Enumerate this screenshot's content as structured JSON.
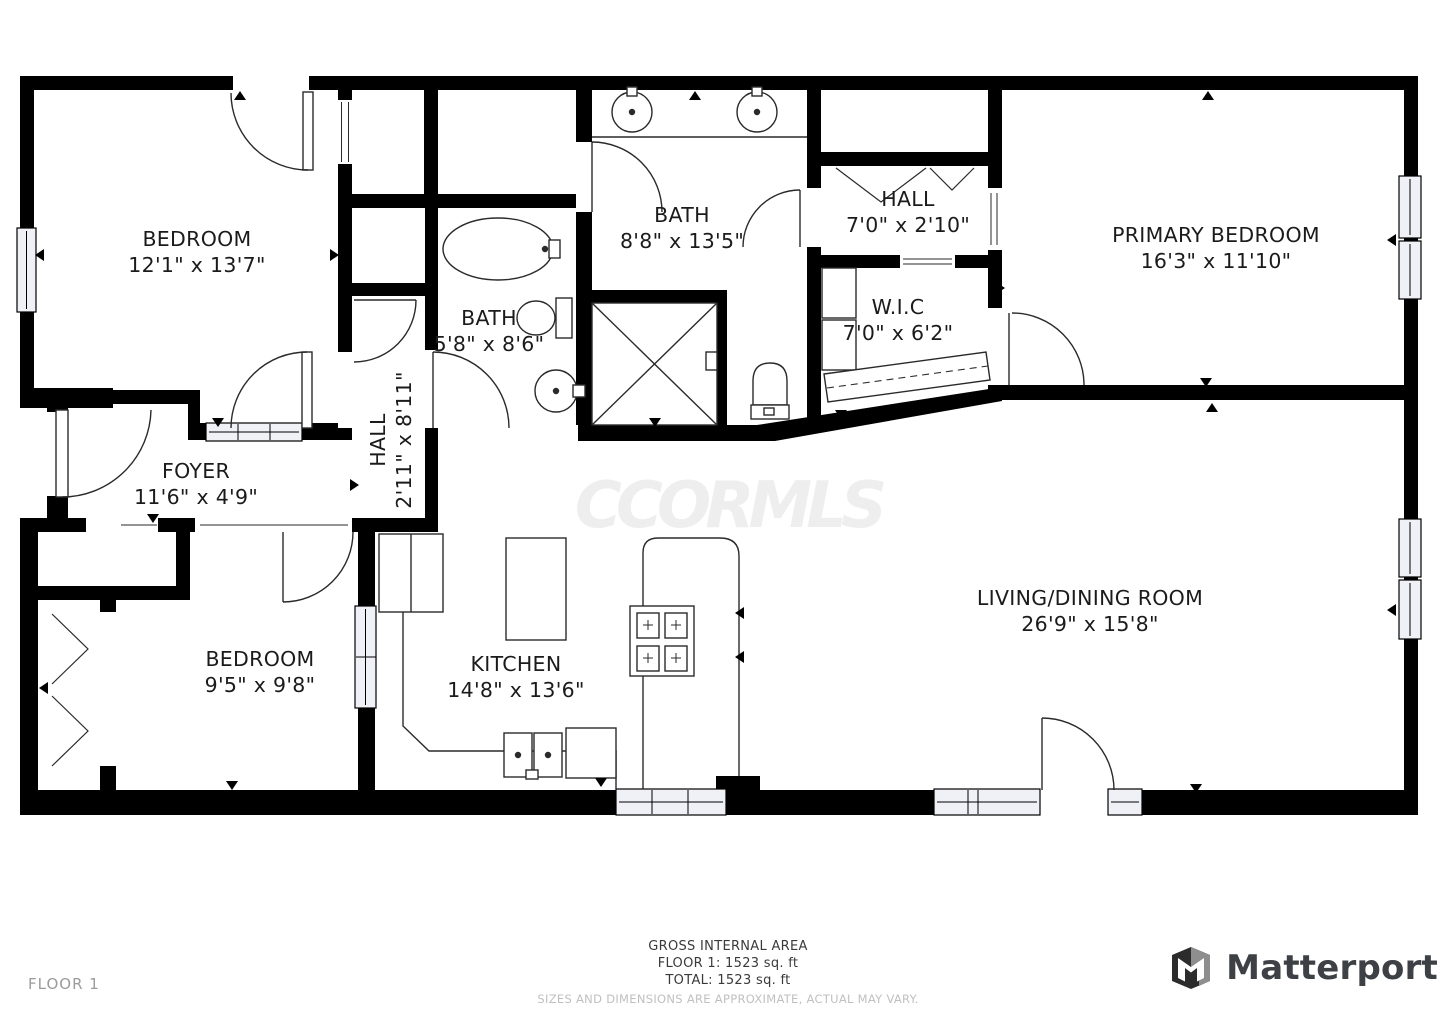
{
  "watermark": "CCORMLS",
  "floor_label": "FLOOR 1",
  "rooms": [
    {
      "name": "BEDROOM",
      "dims": "12'1\" x 13'7\""
    },
    {
      "name": "BATH",
      "dims": "8'8\" x 13'5\""
    },
    {
      "name": "HALL",
      "dims": "7'0\" x 2'10\""
    },
    {
      "name": "PRIMARY BEDROOM",
      "dims": "16'3\" x 11'10\""
    },
    {
      "name": "BATH",
      "dims": "5'8\" x 8'6\""
    },
    {
      "name": "W.I.C",
      "dims": "7'0\" x 6'2\""
    },
    {
      "name": "HALL",
      "dims": "2'11\" x 8'11\""
    },
    {
      "name": "FOYER",
      "dims": "11'6\" x 4'9\""
    },
    {
      "name": "BEDROOM",
      "dims": "9'5\" x 9'8\""
    },
    {
      "name": "KITCHEN",
      "dims": "14'8\" x 13'6\""
    },
    {
      "name": "LIVING/DINING ROOM",
      "dims": "26'9\" x 15'8\""
    }
  ],
  "footer": {
    "area_title": "GROSS INTERNAL AREA",
    "floor_area": "FLOOR 1: 1523 sq. ft",
    "total_area": "TOTAL: 1523 sq. ft",
    "disclaimer": "SIZES AND DIMENSIONS ARE APPROXIMATE, ACTUAL MAY VARY."
  },
  "brand": {
    "name": "Matterport"
  }
}
